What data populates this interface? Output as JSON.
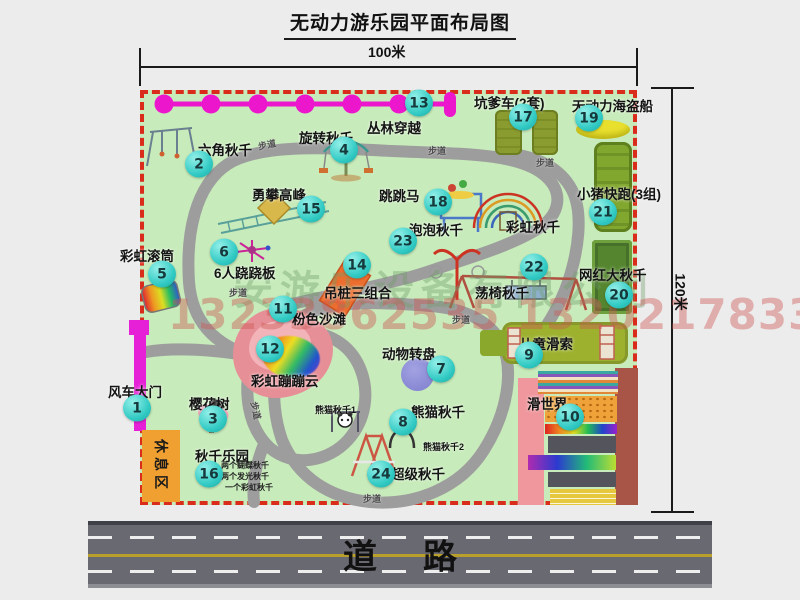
{
  "title": "无动力游乐园平面布局图",
  "dimensions": {
    "width_label": "100米",
    "height_label": "120米"
  },
  "road": {
    "label": "道路"
  },
  "walkway_label": "步道",
  "watermark": {
    "company": "安游乐设备有限公司",
    "phone": "13233862535 13202178333"
  },
  "colors": {
    "park_green": "#c7ebba",
    "border_red": "#da2c1b",
    "badge_cyan": "#32cac4",
    "magenta": "#e620d6",
    "road_gray": "#696972",
    "rest_orange": "#f0a030",
    "pink_beach": "#e78f96",
    "pirate_yellow": "#e9e02e"
  },
  "features": [
    {
      "num": "1",
      "label": "风车大门"
    },
    {
      "num": "2",
      "label": "六角秋千"
    },
    {
      "num": "3",
      "label": "樱花树"
    },
    {
      "num": "4",
      "label": "旋转秋千"
    },
    {
      "num": "5",
      "label": "彩虹滚筒"
    },
    {
      "num": "6",
      "label": "6人跷跷板"
    },
    {
      "num": "7",
      "label": "动物转盘"
    },
    {
      "num": "8",
      "label": "熊猫秋千"
    },
    {
      "num": "9",
      "label": "儿童滑索"
    },
    {
      "num": "10",
      "label": "滑世界"
    },
    {
      "num": "11",
      "label": "粉色沙滩"
    },
    {
      "num": "12",
      "label": "彩虹蹦蹦云"
    },
    {
      "num": "13",
      "label": "丛林穿越"
    },
    {
      "num": "14",
      "label": "吊桩三组合"
    },
    {
      "num": "15",
      "label": "勇攀高峰"
    },
    {
      "num": "16",
      "label": "秋千乐园",
      "notes": [
        "两个蝴蝶秋千",
        "两个发光秋千",
        "一个彩虹秋千"
      ]
    },
    {
      "num": "17",
      "label": "坑爹车(2套)"
    },
    {
      "num": "18",
      "label": "跳跳马"
    },
    {
      "num": "19",
      "label": "无动力海盗船"
    },
    {
      "num": "20",
      "label": "网红大秋千"
    },
    {
      "num": "21",
      "label": "小猪快跑(3组)"
    },
    {
      "num": "22",
      "label": "荡椅秋千"
    },
    {
      "num": "23",
      "label": "泡泡秋千"
    },
    {
      "num": "24",
      "label": "超级秋千"
    }
  ],
  "unnumbered": {
    "rainbow_swing": "彩虹秋千",
    "rest_area": "休息区",
    "panda_swing_1": "熊猫秋千1",
    "panda_swing_2": "熊猫秋千2"
  }
}
